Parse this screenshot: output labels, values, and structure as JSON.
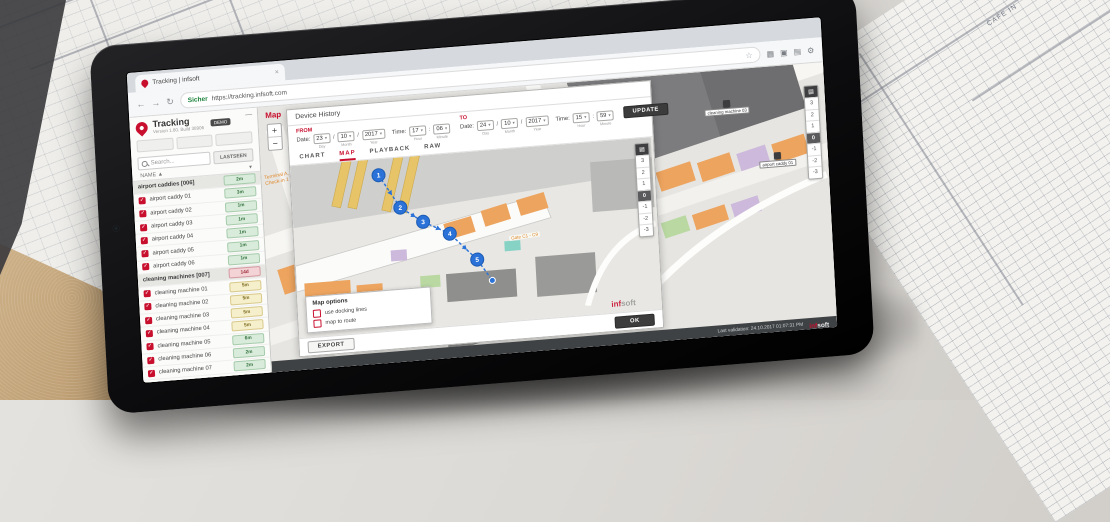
{
  "background": {
    "blueprint_label": "CAFE IN"
  },
  "browser": {
    "tab_title": "Tracking | infsoft",
    "close_tab": "×",
    "back": "←",
    "forward": "→",
    "reload": "↻",
    "secure_label": "Sicher",
    "url": "https://tracking.infsoft.com",
    "bookmark_star": "☆"
  },
  "sidebar": {
    "app_title": "Tracking",
    "version": "Version 1.80, Build 38906",
    "badge": "DEMO",
    "collapse": "—",
    "search_placeholder": "Search...",
    "lastseen_header": "LASTSEEN",
    "name_header": "NAME ▲",
    "name_menu": "▾",
    "groups": [
      {
        "label": "airport caddies [006]",
        "badge": "2m"
      },
      {
        "label": "cleaning machines [007]",
        "badge": "14d"
      }
    ],
    "rows": [
      {
        "name": "airport caddy 01",
        "badge": "3m"
      },
      {
        "name": "airport caddy 02",
        "badge": "1m"
      },
      {
        "name": "airport caddy 03",
        "badge": "1m"
      },
      {
        "name": "airport caddy 04",
        "badge": "1m"
      },
      {
        "name": "airport caddy 05",
        "badge": "1m"
      },
      {
        "name": "airport caddy 06",
        "badge": "1m"
      },
      {
        "name": "cleaning machine 01",
        "badge": "5m"
      },
      {
        "name": "cleaning machine 02",
        "badge": "5m"
      },
      {
        "name": "cleaning machine 03",
        "badge": "5m"
      },
      {
        "name": "cleaning machine 04",
        "badge": "5m"
      },
      {
        "name": "cleaning machine 05",
        "badge": "6m"
      },
      {
        "name": "cleaning machine 06",
        "badge": "2m"
      },
      {
        "name": "cleaning machine 07",
        "badge": "2m"
      }
    ]
  },
  "map": {
    "title": "Map",
    "zoom_in": "+",
    "zoom_out": "−",
    "floor_icon": "▤",
    "floors": [
      "3",
      "2",
      "1",
      "0",
      "-1",
      "-2",
      "-3"
    ],
    "active_floor": "0",
    "poi_terminal": "Terminal A, Check-in 1",
    "poi_gate": "Gate C1 - C9",
    "marker_labels": [
      "cleaning machine 03",
      "airport caddy 01"
    ],
    "accent_color": "#c8102e",
    "route_color": "#2a72d8"
  },
  "device_history": {
    "title": "Device History",
    "from_label": "FROM",
    "to_label": "TO",
    "date_label": "Date:",
    "time_label": "Time:",
    "from": {
      "day": "23",
      "month": "10",
      "year": "2017",
      "hour": "17",
      "minute": "06"
    },
    "to": {
      "day": "24",
      "month": "10",
      "year": "2017",
      "hour": "15",
      "minute": "59"
    },
    "sub_labels": {
      "day": "Day",
      "month": "Month",
      "year": "Year",
      "hour": "Hour",
      "minute": "Minute"
    },
    "update_button": "UPDATE",
    "tabs": [
      "CHART",
      "MAP",
      "PLAYBACK",
      "RAW"
    ],
    "active_tab": "MAP",
    "route": [
      "1",
      "2",
      "3",
      "4",
      "5"
    ],
    "map_options": {
      "title": "Map options",
      "options": [
        "use docking lines",
        "map to route"
      ],
      "ok_button": "OK"
    },
    "export_button": "EXPORT",
    "watermark_inf": "inf",
    "watermark_soft": "soft"
  },
  "footer": {
    "status": "Last validation: 24.10.2017 01:07:31 PM",
    "logo_inf": "inf",
    "logo_soft": "soft"
  }
}
